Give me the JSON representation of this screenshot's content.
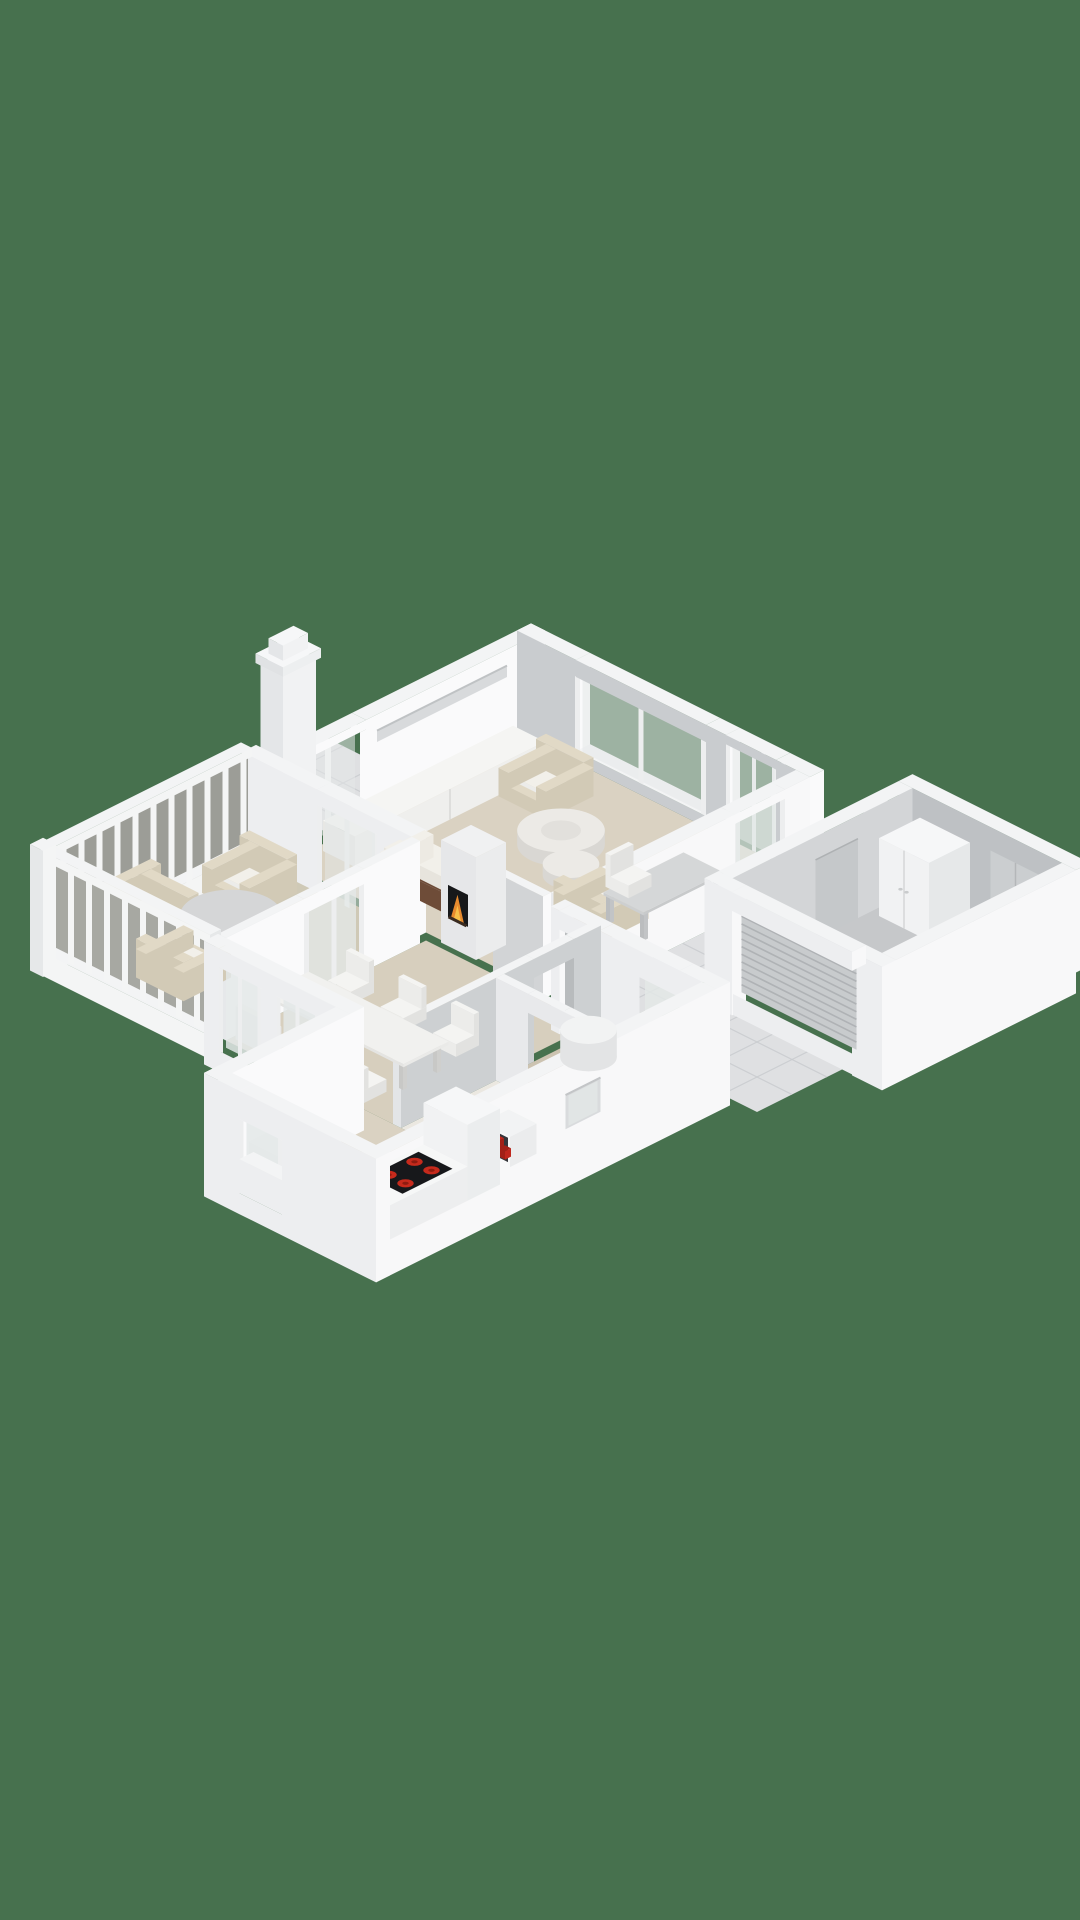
{
  "view": {
    "type": "3d-floorplan-render",
    "projection": "isometric-2to1",
    "background": "#47714E"
  },
  "palette": {
    "bg": "#47714E",
    "floorBeige": "#DAD2C2",
    "floorDining": "#D7CFBE",
    "floorHall": "#CCC3B1",
    "floorBath": "#EBE8E1",
    "floorVeranda": "#CFC9B6",
    "floorGarage": "#C6C8CA",
    "tile": "#DFE0E2",
    "tileLine": "#C9CBCE",
    "wallTop": "#F3F4F5",
    "wallBright": "#FAFAFB",
    "wallGreyIn": "#C9CCCF",
    "wallExtY": "#EDEEF0",
    "wallExtX": "#F8F8F9",
    "wallDark": "#BEC1C4",
    "wallMid": "#D3D5D7",
    "glass": "#E3E8E7",
    "slatBackNW": "#9C9D97",
    "slatBackSW": "#A7A8A2",
    "slatWhite": "#F4F5F5",
    "doorGrey": "#B8BBBD",
    "garDoor": "#C8CBCD",
    "garDoorLine": "#AFB2B5",
    "wood": "#6E4C38",
    "beigeF": "#E1D9C6",
    "beigeFs": "#D2CAB6",
    "cushion": "#F2F0EA",
    "marbleTop": "#ECEAE6",
    "marbleSide": "#D9D7D3",
    "deskTop": "#D5D7D8",
    "chairW": "#F4F4F2",
    "chairWs": "#E2E2E0",
    "chairWy": "#ECECEA",
    "counter": "#F6F7F7",
    "counterS": "#EDEEEF",
    "cooktop": "#17181B",
    "burner": "#C62A1C",
    "burnerC": "#8E1B10",
    "fire": "#E78A2E",
    "fireIn": "#F6C049",
    "red": "#BF271D",
    "redDark": "#A22017",
    "tableGrey": "#D5D6D7",
    "tableGreyS": "#C7C9CA",
    "nicheDark": "#35363A",
    "legGrey": "#D8D8D6"
  },
  "rooms": [
    {
      "name": "living-room",
      "floor": "#DAD2C2"
    },
    {
      "name": "dining-room",
      "floor": "#D7CFBE"
    },
    {
      "name": "kitchen",
      "floor": "#DAD2C2"
    },
    {
      "name": "hallway",
      "floor": "#CCC3B1"
    },
    {
      "name": "bathroom",
      "floor": "#EBE8E1"
    },
    {
      "name": "veranda",
      "floor": "#CFC9B6"
    },
    {
      "name": "garage",
      "floor": "#C6C8CA"
    },
    {
      "name": "entry-porch",
      "floor": "tiled"
    },
    {
      "name": "patio-walkway",
      "floor": "tiled"
    },
    {
      "name": "driveway",
      "floor": "tiled"
    }
  ],
  "furniture": [
    "sofa",
    "armchair-north",
    "armchair-east",
    "coffee-table-large",
    "coffee-table-small",
    "sideboard",
    "desk",
    "desk-chair",
    "dining-table",
    "dining-chairs",
    "fireplace",
    "kitchen-counter-l",
    "cooktop",
    "tall-cabinet",
    "veranda-round-table",
    "veranda-armchairs",
    "hall-round-table",
    "wall-niche-red-items",
    "wardrobe",
    "garage-sectional-door",
    "chimney"
  ],
  "counts": {
    "dining_chairs": 6,
    "veranda_armchairs": 3,
    "cooktop_burners": 4,
    "living_armchairs": 2
  }
}
